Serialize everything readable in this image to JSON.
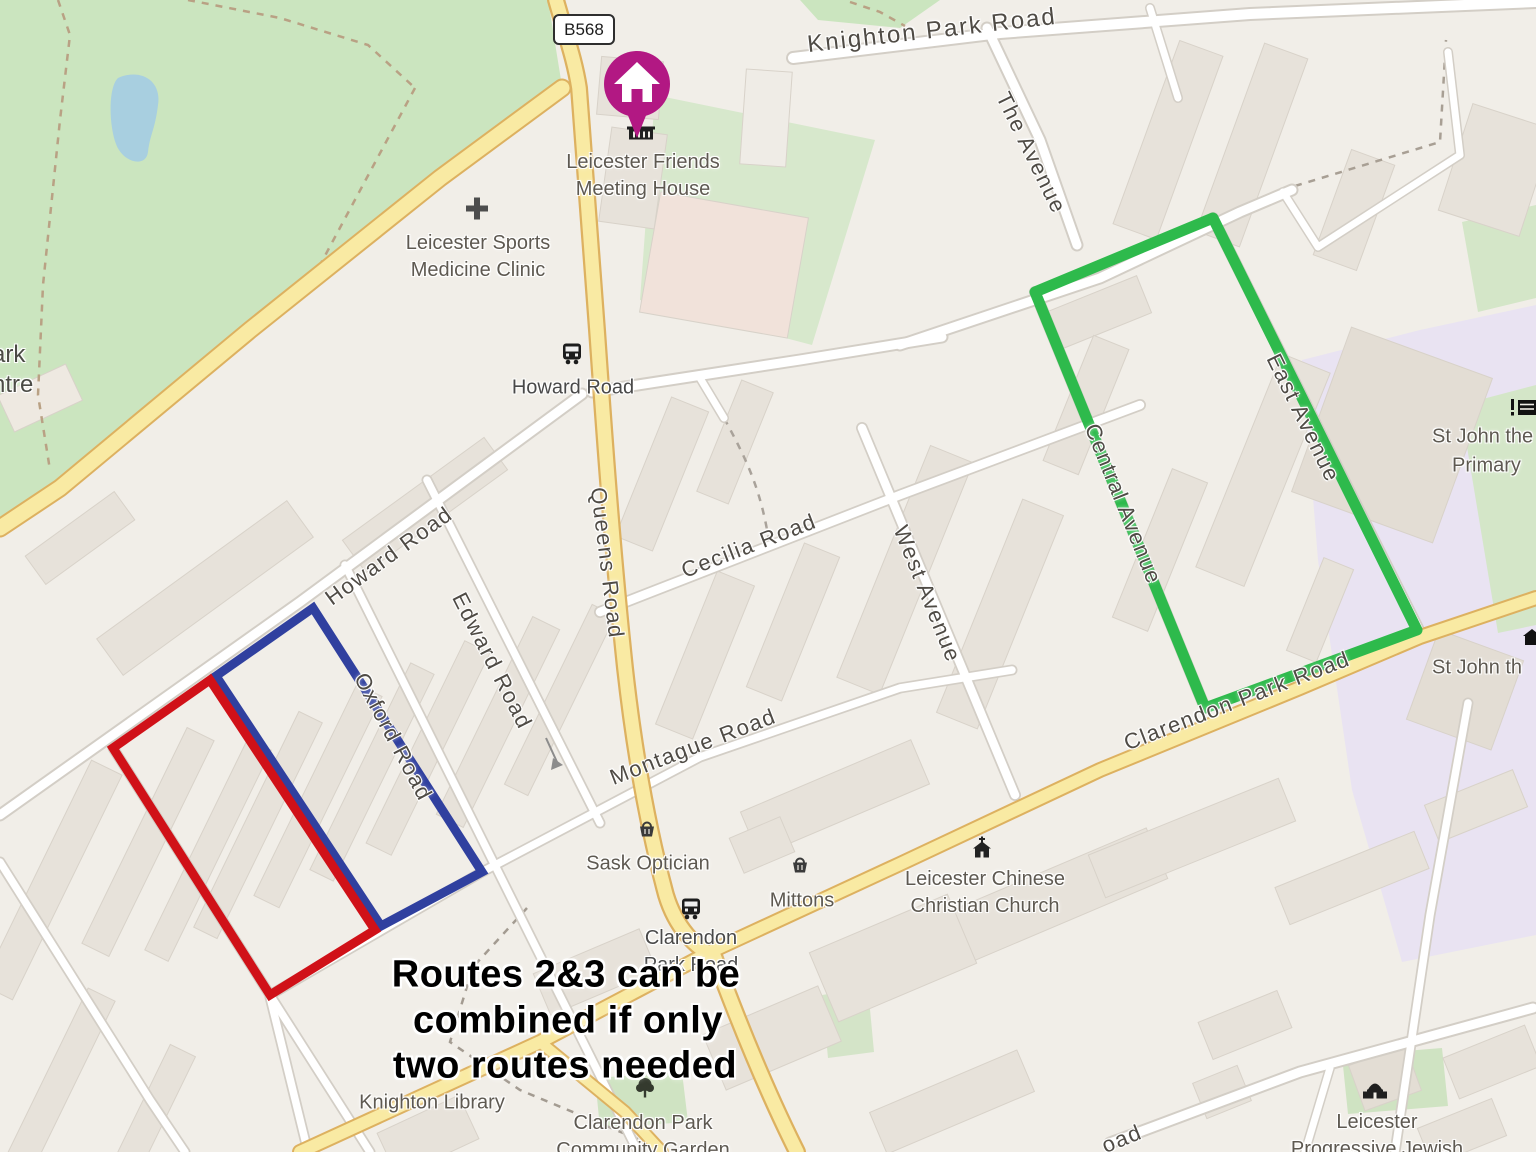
{
  "map": {
    "badge": "B568",
    "note": {
      "line1": "Routes 2&3 can be",
      "line2": "combined if only",
      "line3": "two routes needed"
    },
    "marker": {
      "name": "Leicester Friends Meeting House",
      "color": "#b21883"
    },
    "routes": {
      "green": {
        "color": "#2eba4c"
      },
      "blue": {
        "color": "#30409f"
      },
      "red": {
        "color": "#d01118"
      }
    },
    "roads": {
      "knighton_park": "Knighton Park Road",
      "the_avenue": "The Avenue",
      "queens": "Queens Road",
      "howard": "Howard Road",
      "cecilia": "Cecilia Road",
      "edward": "Edward Road",
      "oxford": "Oxford Road",
      "west_avenue": "West Avenue",
      "central_avenue": "Central Avenue",
      "east_avenue": "East Avenue",
      "clarendon_park": "Clarendon Park Road",
      "montague": "Montague Road",
      "fragment_road": "oad",
      "fragment_park": "ark",
      "fragment_centre": "ntre"
    },
    "bus_stops": {
      "howard": "Howard Road",
      "clarendon_line1": "Clarendon",
      "clarendon_line2": "Park Road"
    },
    "pois": {
      "friends": {
        "line1": "Leicester Friends",
        "line2": "Meeting House"
      },
      "clinic": {
        "line1": "Leicester Sports",
        "line2": "Medicine Clinic"
      },
      "sask": "Sask Optician",
      "mittons": "Mittons",
      "chinese_church": {
        "line1": "Leicester Chinese",
        "line2": "Christian Church"
      },
      "library": "Knighton Library",
      "garden": {
        "line1": "Clarendon Park",
        "line2": "Community Garden"
      },
      "jewish": {
        "line1": "Leicester",
        "line2": "Progressive Jewish"
      },
      "st_john_primary": {
        "line1": "St John the",
        "line2": "Primary"
      },
      "st_john_partial": "St John th"
    }
  }
}
